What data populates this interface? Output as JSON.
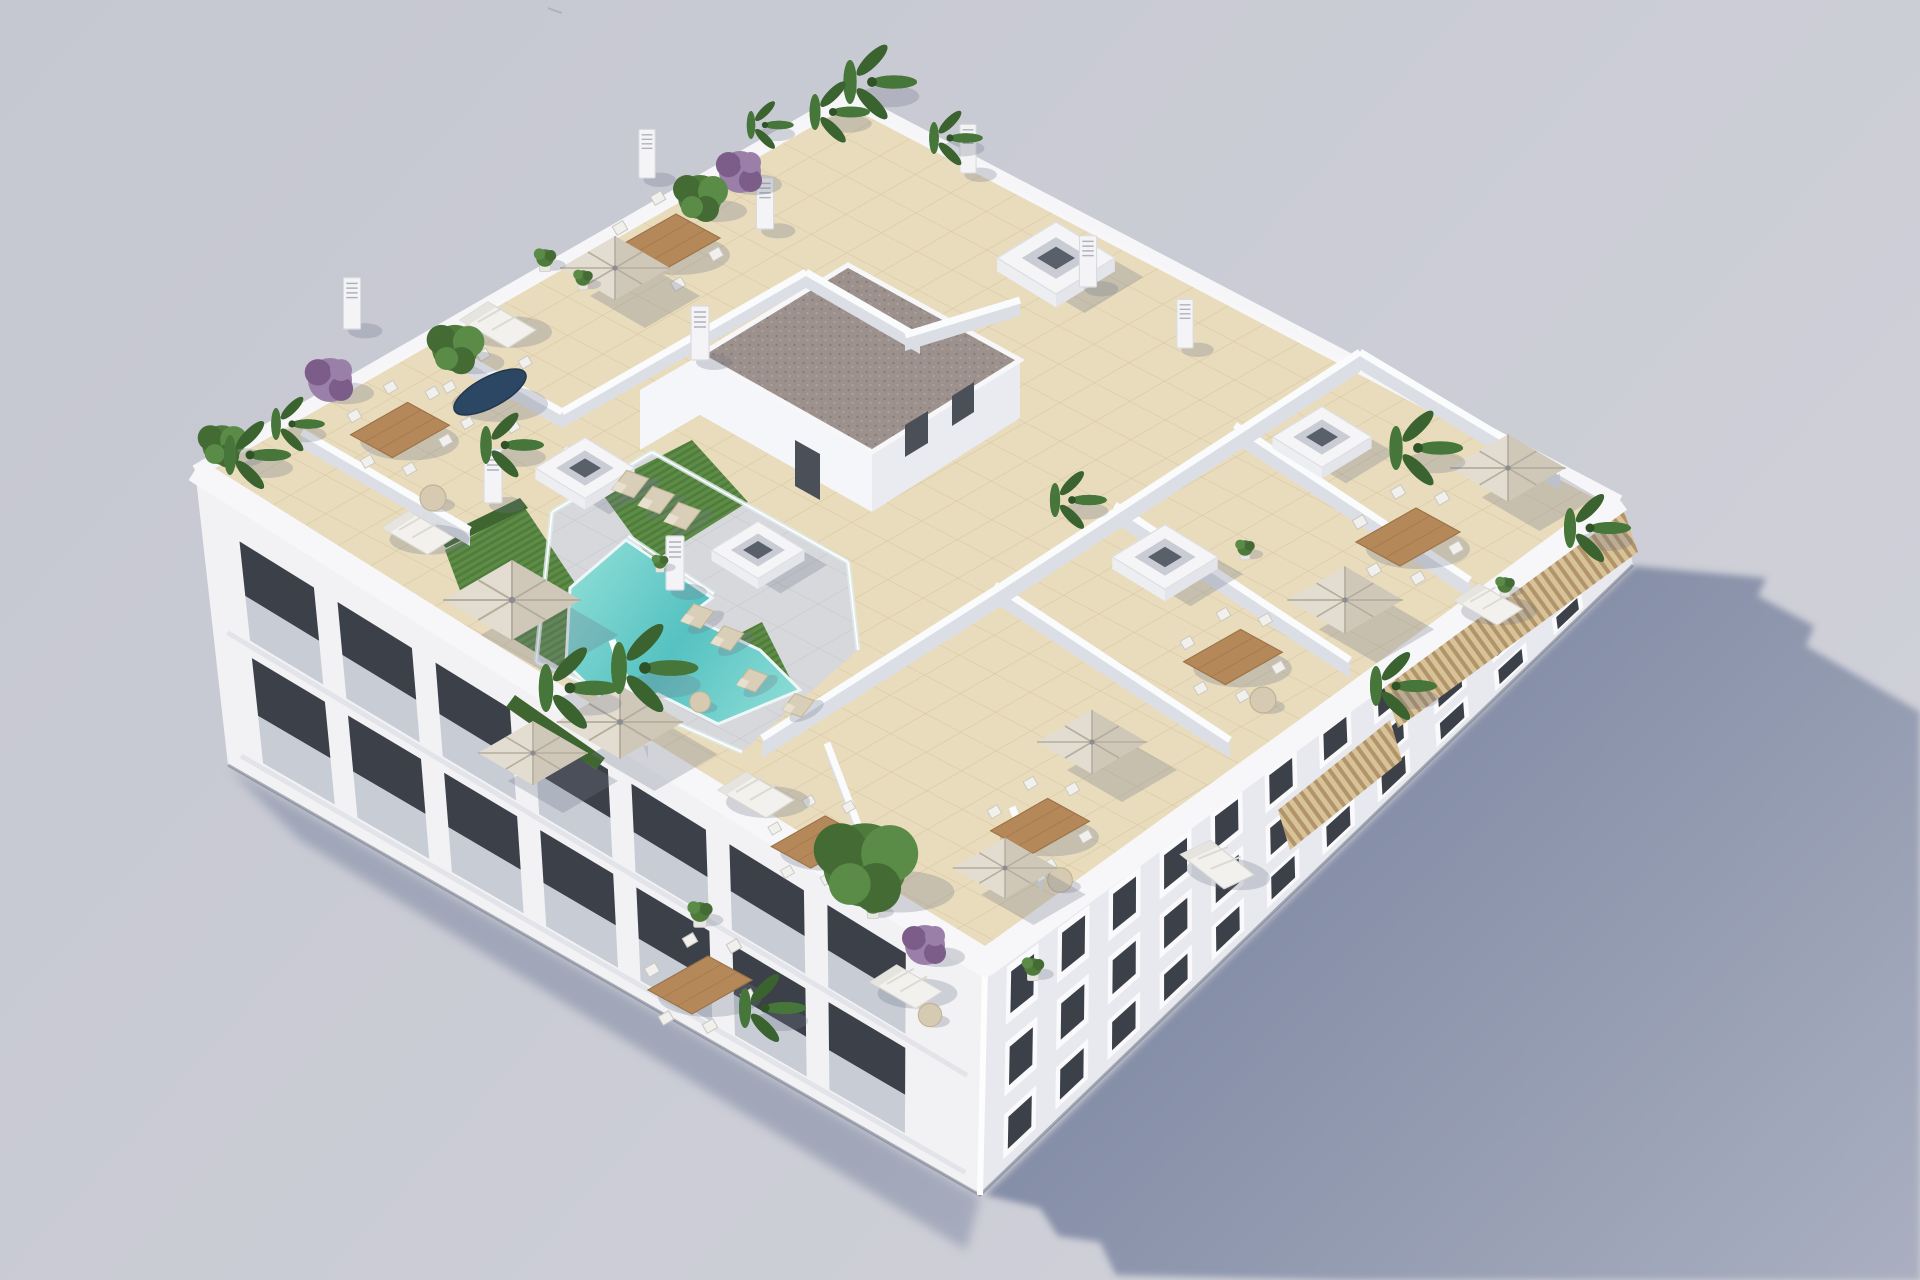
{
  "image": {
    "description": "Aerial 3D architectural render of a white low-rise apartment building viewed from above at an angle. The rooftop holds a communal terrace with a turquoise stepped swimming pool, artificial grass with sun loungers, glass balustrades, beige tiled private terraces separated by white walls, wooden dining sets with white chairs, white outdoor sofas, beige square parasols, skylight boxes, vent pillars, a stair core with a brown gravel flat roof, a wooden slat pergola along the right edge, and many palms and purple flowering bushes. The building casts a long blue-grey shadow to the lower right on a plain grey backdrop.",
    "width": 1920,
    "height": 1280
  },
  "colors": {
    "bg1": "#c5c7d1",
    "bg2": "#cfd0d8",
    "shadow1": "#7f89a3",
    "shadow2": "#a9afc0",
    "facadeSW": "#f2f2f5",
    "facadeSE": "#e8e9ee",
    "parapet": "#f7f7f9",
    "wallFace": "#dcdee5",
    "wallTop": "#fafbfc",
    "tile": "#e9dcbd",
    "tileLine": "#d9c9a2",
    "deckC": "#d7d8dc",
    "deckLine": "#c6c7cc",
    "pool1": "#55c2c1",
    "pool2": "#92dfd8",
    "grass": "#5d8c47",
    "grassDark": "#4f7b3b",
    "hedge": "#3f6631",
    "gravel": "#9d918d",
    "gravelDot": "#857a76",
    "wood": "#b5885a",
    "woodDark": "#9c7347",
    "canopyA": "#e3ddd1",
    "canopyB": "#cfc7b8",
    "canopyRib": "#b5ad9d",
    "glassFence": "#dfeef0",
    "windowGlass": "#3c4149",
    "rail": "#c3c9d1",
    "palmA": "#47763a",
    "palmB": "#3a6330",
    "treeA": "#4e7a3c",
    "treeB": "#446b34",
    "treeC": "#5a8c48",
    "purpleA": "#9a7fa8",
    "purpleB": "#7c5c88",
    "potC": "#e8e6e1",
    "slatA": "#d8c297",
    "slatB": "#b2946a",
    "shadBlob": "#70758a",
    "chairW": "#f1f0ec",
    "sofaW": "#f2f1ed",
    "loungeA": "#d9cfb8",
    "skyFace": "#e3e5ea",
    "skyIn": "#c9ccd4",
    "skyCore": "#5a6069",
    "door": "#4a4f58",
    "baseLine": "#6e7583"
  },
  "scene": {
    "counts": {
      "palm_trees": 13,
      "green_trees": 4,
      "purple_bushes": 3,
      "potted_plants": 8,
      "parasols": 8,
      "dining_table_sets": 7,
      "oval_tables": 1,
      "outdoor_sofas": 6,
      "sun_loungers": 7,
      "side_tables": 5,
      "skylight_boxes": 5,
      "vent_pillars": 8,
      "pools": 1,
      "building_floors_visible": 3
    },
    "walls": [
      {
        "seg": [
          432,
          338,
          562,
          412
        ]
      },
      {
        "seg": [
          562,
          412,
          806,
          272
        ]
      },
      {
        "seg": [
          806,
          272,
          920,
          338
        ]
      },
      {
        "seg": [
          905,
          335,
          1020,
          300
        ]
      },
      {
        "seg": [
          302,
          432,
          470,
          530
        ]
      },
      {
        "seg": [
          995,
          585,
          1230,
          740
        ],
        "h": 18
      },
      {
        "seg": [
          1115,
          505,
          1350,
          660
        ],
        "h": 18
      },
      {
        "seg": [
          1235,
          425,
          1470,
          580
        ],
        "h": 18
      },
      {
        "seg": [
          998,
          588,
          1360,
          352
        ],
        "h": 20
      },
      {
        "seg": [
          1360,
          352,
          1560,
          472
        ],
        "h": 18
      },
      {
        "seg": [
          762,
          738,
          998,
          588
        ],
        "h": 20
      },
      {
        "seg": [
          612,
          640,
          648,
          745
        ],
        "h": 14
      },
      {
        "seg": [
          827,
          743,
          862,
          835
        ],
        "h": 14
      },
      {
        "seg": [
          1012,
          807,
          1042,
          880
        ],
        "h": 14
      }
    ],
    "fences": [
      [
        552,
        512,
        652,
        452
      ],
      [
        652,
        452,
        848,
        562
      ],
      [
        848,
        562,
        858,
        650
      ],
      [
        536,
        662,
        742,
        752
      ],
      [
        536,
        662,
        552,
        512
      ],
      [
        565,
        448,
        630,
        492
      ],
      [
        628,
        536,
        714,
        594
      ]
    ],
    "facades": [
      {
        "id": "sw-facade",
        "style": "balcony",
        "quad": [
          [
            195,
            470
          ],
          [
            985,
            965
          ],
          [
            980,
            1195
          ],
          [
            228,
            765
          ]
        ],
        "floors": [
          {
            "top": 0.16,
            "bot": 0.5
          },
          {
            "top": 0.56,
            "bot": 0.92
          }
        ],
        "bays": [
          [
            0.05,
            0.145
          ],
          [
            0.175,
            0.27
          ],
          [
            0.3,
            0.395
          ],
          [
            0.425,
            0.52
          ],
          [
            0.55,
            0.645
          ],
          [
            0.675,
            0.77
          ],
          [
            0.8,
            0.9
          ]
        ]
      },
      {
        "id": "se-facade",
        "style": "window",
        "quad": [
          [
            985,
            965
          ],
          [
            1620,
            500
          ],
          [
            1633,
            565
          ],
          [
            980,
            1195
          ]
        ],
        "floors": [
          {
            "top": 0.08,
            "bot": 0.34
          },
          {
            "top": 0.42,
            "bot": 0.66
          },
          {
            "top": 0.74,
            "bot": 0.94
          }
        ],
        "bays": [
          [
            0.035,
            0.085
          ],
          [
            0.115,
            0.165
          ],
          [
            0.195,
            0.245
          ],
          [
            0.275,
            0.325
          ],
          [
            0.355,
            0.405
          ],
          [
            0.44,
            0.49
          ],
          [
            0.525,
            0.575
          ],
          [
            0.61,
            0.66
          ],
          [
            0.7,
            0.75
          ],
          [
            0.79,
            0.84
          ],
          [
            0.88,
            0.925
          ]
        ]
      }
    ],
    "items": [
      {
        "t": "skylight",
        "x": 1056,
        "y": 258,
        "s": 0.95
      },
      {
        "t": "skylight",
        "x": 585,
        "y": 468,
        "s": 0.8
      },
      {
        "t": "skylight",
        "x": 758,
        "y": 550,
        "s": 0.75
      },
      {
        "t": "skylight",
        "x": 1165,
        "y": 557,
        "s": 0.85
      },
      {
        "t": "skylight",
        "x": 1322,
        "y": 437,
        "s": 0.8
      },
      {
        "t": "pillar",
        "x": 647,
        "y": 160,
        "s": 0.9
      },
      {
        "t": "pillar",
        "x": 765,
        "y": 210,
        "s": 0.95
      },
      {
        "t": "pillar",
        "x": 968,
        "y": 155,
        "s": 0.9
      },
      {
        "t": "pillar",
        "x": 1088,
        "y": 268,
        "s": 0.95
      },
      {
        "t": "pillar",
        "x": 700,
        "y": 340,
        "s": 1
      },
      {
        "t": "pillar",
        "x": 493,
        "y": 483,
        "s": 1
      },
      {
        "t": "pillar",
        "x": 675,
        "y": 570,
        "s": 1
      },
      {
        "t": "pillar",
        "x": 352,
        "y": 310,
        "s": 0.95
      },
      {
        "t": "pillar",
        "x": 1185,
        "y": 330,
        "s": 0.9
      },
      {
        "t": "lounger",
        "x": 630,
        "y": 486,
        "r": -28,
        "s": 1.1
      },
      {
        "t": "lounger",
        "x": 656,
        "y": 502,
        "r": -28,
        "s": 1.1
      },
      {
        "t": "lounger",
        "x": 682,
        "y": 518,
        "r": -28,
        "s": 1.1
      },
      {
        "t": "lounger",
        "x": 697,
        "y": 618,
        "r": -28,
        "s": 1
      },
      {
        "t": "lounger",
        "x": 727,
        "y": 640,
        "r": -28,
        "s": 1
      },
      {
        "t": "lounger",
        "x": 752,
        "y": 682,
        "r": -28,
        "s": 0.95
      },
      {
        "t": "lounger",
        "x": 798,
        "y": 707,
        "r": -28,
        "s": 0.95
      },
      {
        "t": "table",
        "x": 668,
        "y": 243,
        "s": 1
      },
      {
        "t": "table",
        "x": 400,
        "y": 430,
        "s": 0.95
      },
      {
        "t": "table",
        "x": 700,
        "y": 985,
        "s": 1
      },
      {
        "t": "table",
        "x": 818,
        "y": 842,
        "s": 0.9
      },
      {
        "t": "table",
        "x": 1408,
        "y": 537,
        "s": 1
      },
      {
        "t": "table",
        "x": 1233,
        "y": 657,
        "s": 0.95
      },
      {
        "t": "table",
        "x": 1040,
        "y": 826,
        "s": 0.95
      },
      {
        "t": "oval",
        "x": 490,
        "y": 392,
        "s": 1
      },
      {
        "t": "sofa",
        "x": 500,
        "y": 320,
        "s": 1
      },
      {
        "t": "sofa",
        "x": 420,
        "y": 528,
        "s": 0.95
      },
      {
        "t": "sofa",
        "x": 758,
        "y": 790,
        "s": 1
      },
      {
        "t": "sofa",
        "x": 1220,
        "y": 860,
        "s": 1,
        "r": 8
      },
      {
        "t": "sofa",
        "x": 1490,
        "y": 600,
        "s": 0.9
      },
      {
        "t": "sofa",
        "x": 908,
        "y": 982,
        "s": 0.95
      },
      {
        "t": "round",
        "x": 433,
        "y": 498,
        "s": 1
      },
      {
        "t": "round",
        "x": 1263,
        "y": 700,
        "s": 1
      },
      {
        "t": "round",
        "x": 1060,
        "y": 880,
        "s": 0.95
      },
      {
        "t": "round",
        "x": 930,
        "y": 1015,
        "s": 0.9
      },
      {
        "t": "round",
        "x": 700,
        "y": 702,
        "s": 0.8
      },
      {
        "t": "umbrella",
        "x": 512,
        "y": 600,
        "s": 1.25
      },
      {
        "t": "umbrella",
        "x": 620,
        "y": 722,
        "s": 1.15
      },
      {
        "t": "umbrella",
        "x": 533,
        "y": 753,
        "s": 1
      },
      {
        "t": "umbrella",
        "x": 615,
        "y": 268,
        "s": 1
      },
      {
        "t": "umbrella",
        "x": 1508,
        "y": 468,
        "s": 1.05
      },
      {
        "t": "umbrella",
        "x": 1345,
        "y": 600,
        "s": 1.05
      },
      {
        "t": "umbrella",
        "x": 1092,
        "y": 742,
        "s": 1
      },
      {
        "t": "umbrella",
        "x": 1005,
        "y": 868,
        "s": 0.95
      },
      {
        "t": "bush",
        "x": 545,
        "y": 258,
        "s": 0.8
      },
      {
        "t": "bush",
        "x": 583,
        "y": 278,
        "s": 0.7
      },
      {
        "t": "bush",
        "x": 700,
        "y": 912,
        "s": 0.9
      },
      {
        "t": "bush",
        "x": 1033,
        "y": 967,
        "s": 0.8
      },
      {
        "t": "bush",
        "x": 1245,
        "y": 548,
        "s": 0.7
      },
      {
        "t": "bush",
        "x": 873,
        "y": 905,
        "s": 0.8
      },
      {
        "t": "bush",
        "x": 1505,
        "y": 585,
        "s": 0.7
      },
      {
        "t": "bush",
        "x": 660,
        "y": 562,
        "s": 0.6
      },
      {
        "t": "purple",
        "x": 740,
        "y": 172,
        "s": 1.05
      },
      {
        "t": "purple",
        "x": 330,
        "y": 380,
        "s": 1.1
      },
      {
        "t": "purple",
        "x": 925,
        "y": 945,
        "s": 1
      },
      {
        "t": "tree",
        "x": 700,
        "y": 197,
        "s": 1
      },
      {
        "t": "tree",
        "x": 455,
        "y": 348,
        "s": 1.05
      },
      {
        "t": "tree",
        "x": 222,
        "y": 445,
        "s": 0.9
      },
      {
        "t": "tree",
        "x": 865,
        "y": 865,
        "s": 1.9
      },
      {
        "t": "palm",
        "x": 872,
        "y": 82,
        "s": 1.1
      },
      {
        "t": "palm",
        "x": 833,
        "y": 112,
        "s": 0.9
      },
      {
        "t": "palm",
        "x": 765,
        "y": 125,
        "s": 0.7
      },
      {
        "t": "palm",
        "x": 950,
        "y": 138,
        "s": 0.8
      },
      {
        "t": "palm",
        "x": 250,
        "y": 455,
        "s": 1
      },
      {
        "t": "palm",
        "x": 292,
        "y": 424,
        "s": 0.8
      },
      {
        "t": "palm",
        "x": 505,
        "y": 445,
        "s": 0.95
      },
      {
        "t": "palm",
        "x": 570,
        "y": 688,
        "s": 1.2
      },
      {
        "t": "palm",
        "x": 645,
        "y": 668,
        "s": 1.3
      },
      {
        "t": "palm",
        "x": 765,
        "y": 1008,
        "s": 1
      },
      {
        "t": "palm",
        "x": 1418,
        "y": 448,
        "s": 1.1
      },
      {
        "t": "palm",
        "x": 1590,
        "y": 528,
        "s": 1
      },
      {
        "t": "palm",
        "x": 1396,
        "y": 686,
        "s": 1
      },
      {
        "t": "palm",
        "x": 1072,
        "y": 500,
        "s": 0.85
      }
    ]
  }
}
